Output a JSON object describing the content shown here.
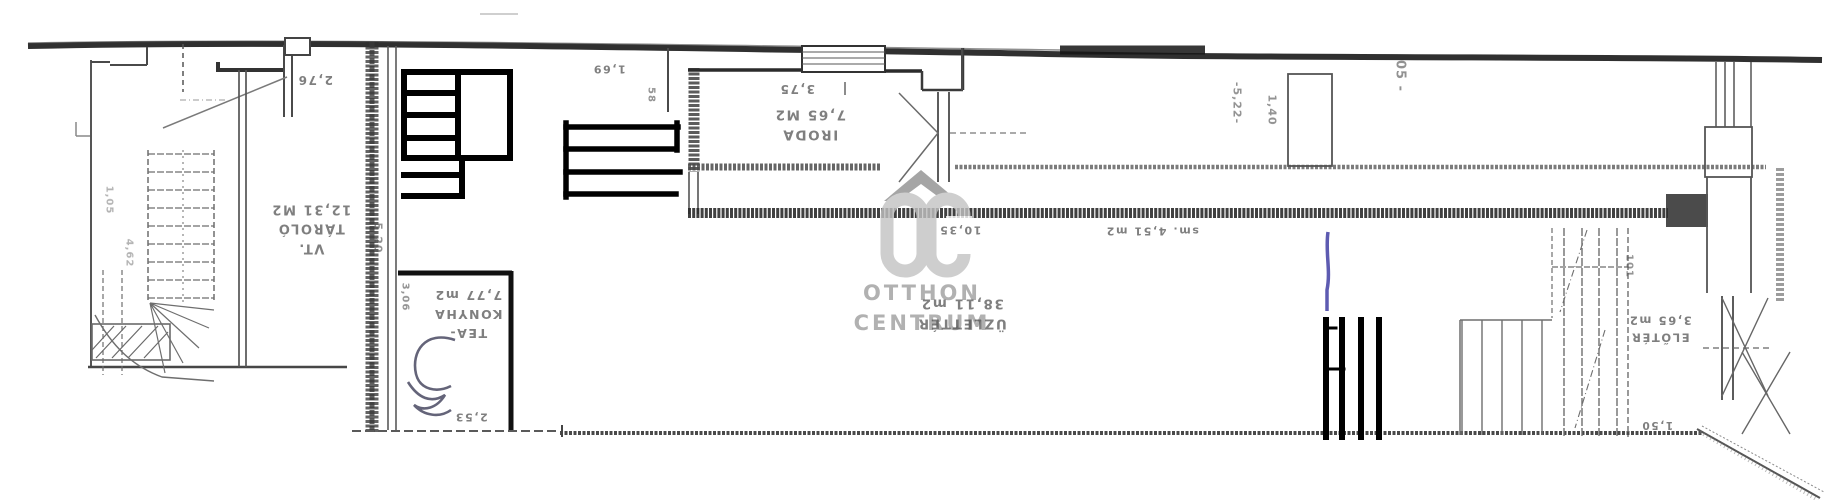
{
  "rooms": {
    "tarolo": {
      "prefix": "VT.",
      "name": "TÁROLÓ",
      "area": "12,31 M2"
    },
    "tea_konyha": {
      "name_line1": "TEA-",
      "name_line2": "KONYHA",
      "area": "7,77 m2"
    },
    "iroda": {
      "name": "IRODA",
      "area": "7,65 M2"
    },
    "uzletter": {
      "name": "ÜZLETTÉR",
      "area": "38,11 m2"
    },
    "eloter": {
      "name": "ELŐTÉR",
      "area": "3,65 m2"
    },
    "hallway": {
      "label": "sm. 4,51 m2"
    },
    "wc_handwritten": "WC"
  },
  "dimensions": {
    "left_door": "2,76",
    "tarolo_depth": "5,20",
    "tea_konyha_width_top": "3,06",
    "tea_konyha_width_bottom": "2,53",
    "hall_width": "1,69",
    "hall_small": "58",
    "iroda_width": "3,75",
    "uzletter_length": "10,35",
    "corridor_length": "-5,22-",
    "corridor_width": "1,40",
    "top_right": "05 -",
    "stair_width": "101",
    "eloter_width": "1,50",
    "left_stair_height": "4,62",
    "left_stair_width": "1,05"
  },
  "watermark": {
    "initials": "OC",
    "line1": "OTTHON",
    "line2": "CENTRUM"
  },
  "colors": {
    "paper": "#ffffff",
    "pencil": "#6b6b6b",
    "wall_dark": "#1f1f1f",
    "marker": "#000000",
    "pen_blue": "#4b49a8",
    "watermark_gray": "#c0c0c0"
  }
}
